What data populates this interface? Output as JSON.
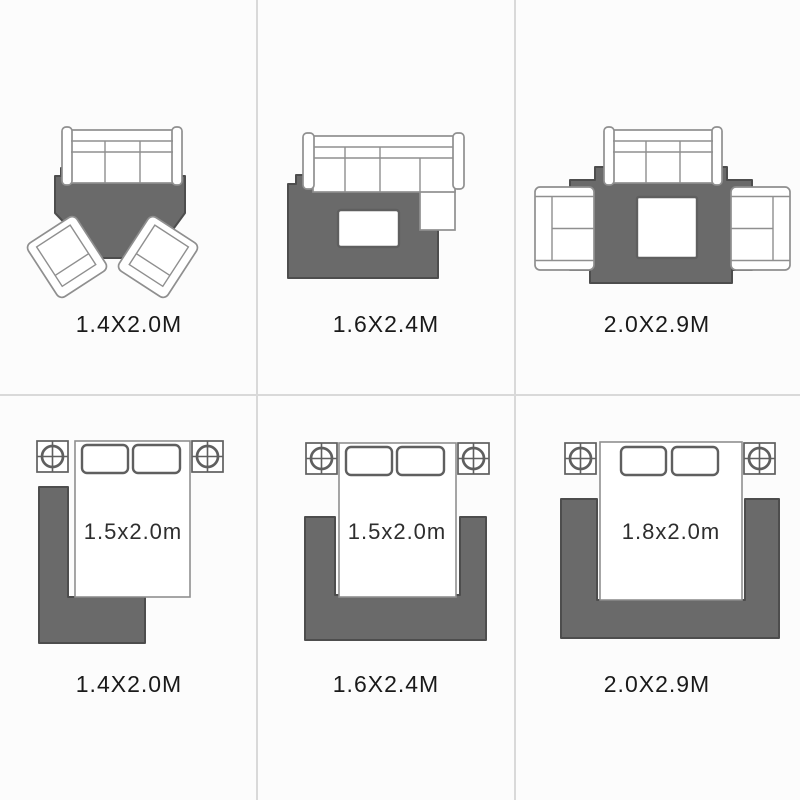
{
  "colors": {
    "background": "#fcfcfc",
    "divider": "#d9d9d9",
    "rug": "#6a6a6a",
    "rugStroke": "#4d4d4d",
    "furnitureStroke": "#8f8f8f",
    "furnitureStrokeDark": "#5f5f5f",
    "furnitureFill": "#ffffff",
    "label": "#1a1a1a",
    "bedLabel": "#2e2e2e"
  },
  "cells": [
    {
      "id": "living-small",
      "scene": "sofa-with-two-armchairs-on-rug",
      "size_label": "1.4X2.0M"
    },
    {
      "id": "living-medium",
      "scene": "sectional-sofa-with-coffee-table-on-rug",
      "size_label": "1.6X2.4M"
    },
    {
      "id": "living-large",
      "scene": "sofa-two-loveseats-coffee-table-on-rug",
      "size_label": "2.0X2.9M"
    },
    {
      "id": "bedroom-small",
      "scene": "bed-nightstands-l-shaped-rug",
      "bed_label": "1.5x2.0m",
      "size_label": "1.4X2.0M"
    },
    {
      "id": "bedroom-medium",
      "scene": "bed-nightstands-u-shaped-rug",
      "bed_label": "1.5x2.0m",
      "size_label": "1.6X2.4M"
    },
    {
      "id": "bedroom-large",
      "scene": "bed-nightstands-u-shaped-rug",
      "bed_label": "1.8x2.0m",
      "size_label": "2.0X2.9M"
    }
  ]
}
